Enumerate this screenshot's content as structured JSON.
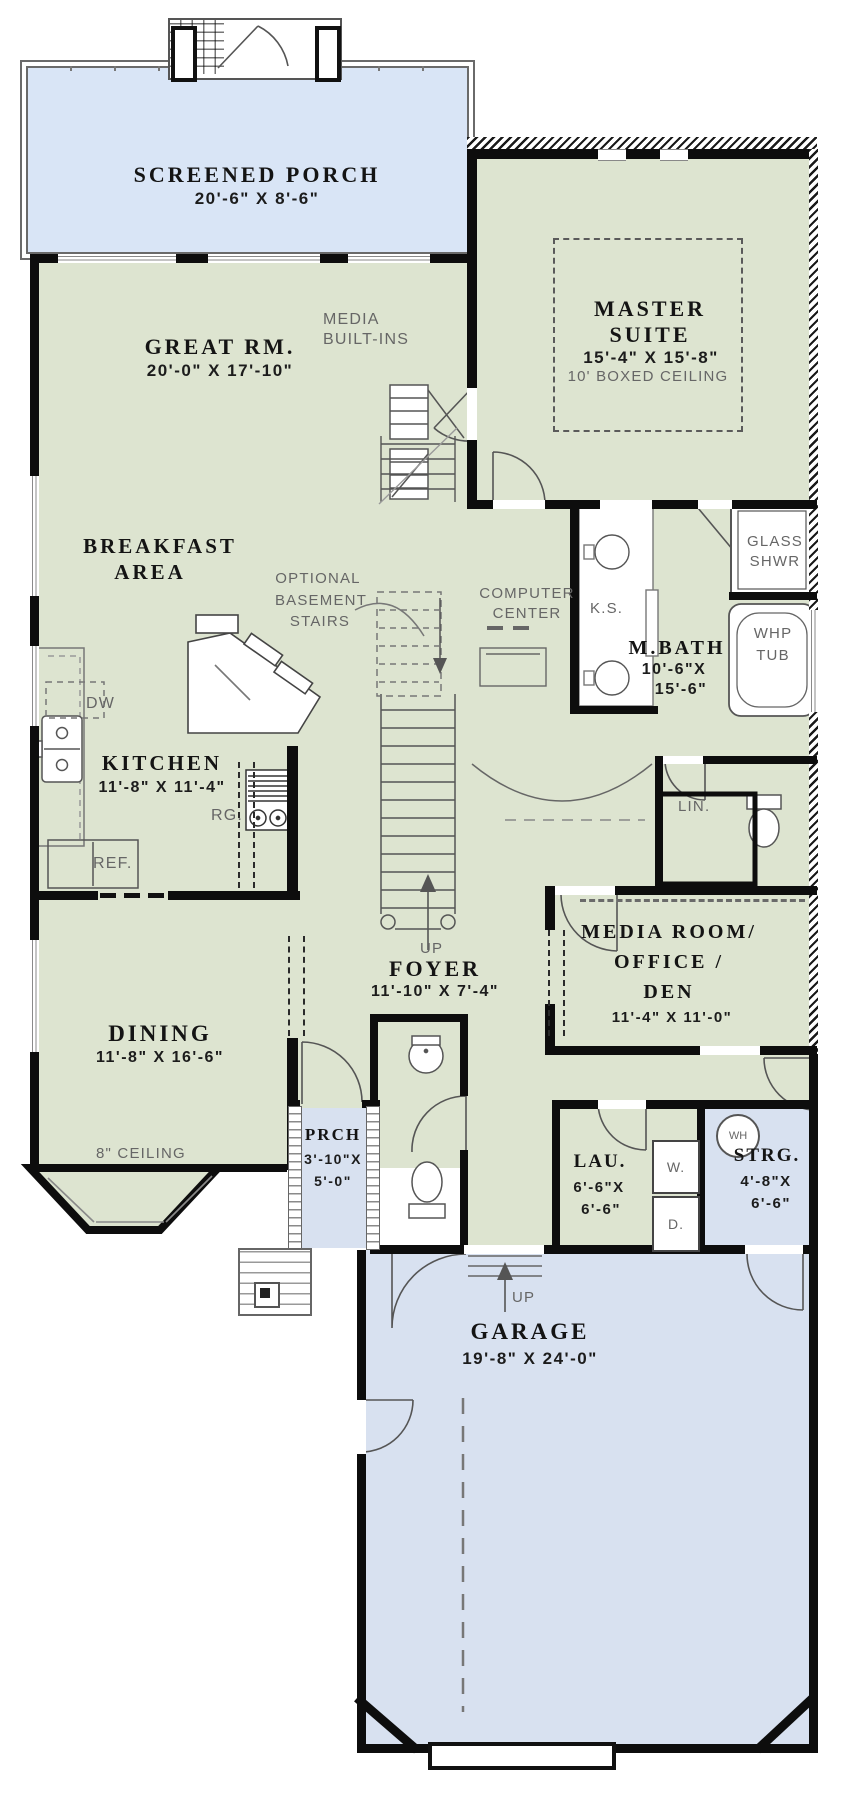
{
  "colors": {
    "room_green": "#dde4d0",
    "porch_blue": "#d9e5f6",
    "garage_blue": "#d8e1f0",
    "wall": "#0d0d0d",
    "annotation_gray": "#666666"
  },
  "rooms": {
    "screened_porch": {
      "name": "SCREENED PORCH",
      "dims": "20'-6\" X 8'-6\""
    },
    "great_room": {
      "name": "GREAT RM.",
      "dims": "20'-0\" X 17'-10\""
    },
    "master_suite": {
      "name1": "MASTER",
      "name2": "SUITE",
      "dims": "15'-4\" X 15'-8\"",
      "ceiling": "10' BOXED CEILING"
    },
    "breakfast": {
      "name1": "BREAKFAST",
      "name2": "AREA"
    },
    "master_bath": {
      "name": "M.BATH",
      "dims1": "10'-6\"X",
      "dims2": "15'-6\""
    },
    "kitchen": {
      "name": "KITCHEN",
      "dims": "11'-8\" X 11'-4\""
    },
    "foyer": {
      "name": "FOYER",
      "dims": "11'-10\" X 7'-4\""
    },
    "media_room": {
      "name1": "MEDIA ROOM/",
      "name2": "OFFICE /",
      "name3": "DEN",
      "dims": "11'-4\" X 11'-0\""
    },
    "dining": {
      "name": "DINING",
      "dims": "11'-8\" X 16'-6\"",
      "ceiling": "8\" CEILING"
    },
    "porch": {
      "name": "PRCH",
      "dims1": "3'-10\"X",
      "dims2": "5'-0\""
    },
    "laundry": {
      "name": "LAU.",
      "dims1": "6'-6\"X",
      "dims2": "6'-6\""
    },
    "storage": {
      "name": "STRG.",
      "dims1": "4'-8\"X",
      "dims2": "6'-6\""
    },
    "garage": {
      "name": "GARAGE",
      "dims": "19'-8\" X 24'-0\""
    }
  },
  "annotations": {
    "media_builtins1": "MEDIA",
    "media_builtins2": "BUILT-INS",
    "optional1": "OPTIONAL",
    "optional2": "BASEMENT",
    "optional3": "STAIRS",
    "computer1": "COMPUTER",
    "computer2": "CENTER",
    "kitchen_sink_island": "K.S.",
    "glass1": "GLASS",
    "glass2": "SHWR",
    "whp1": "WHP",
    "whp2": "TUB",
    "dishwasher": "DW",
    "range": "RG.",
    "refrigerator": "REF.",
    "linen": "LIN.",
    "up_stairs": "UP",
    "up_garage": "UP",
    "washer": "W.",
    "dryer": "D.",
    "water_heater": "WH"
  }
}
